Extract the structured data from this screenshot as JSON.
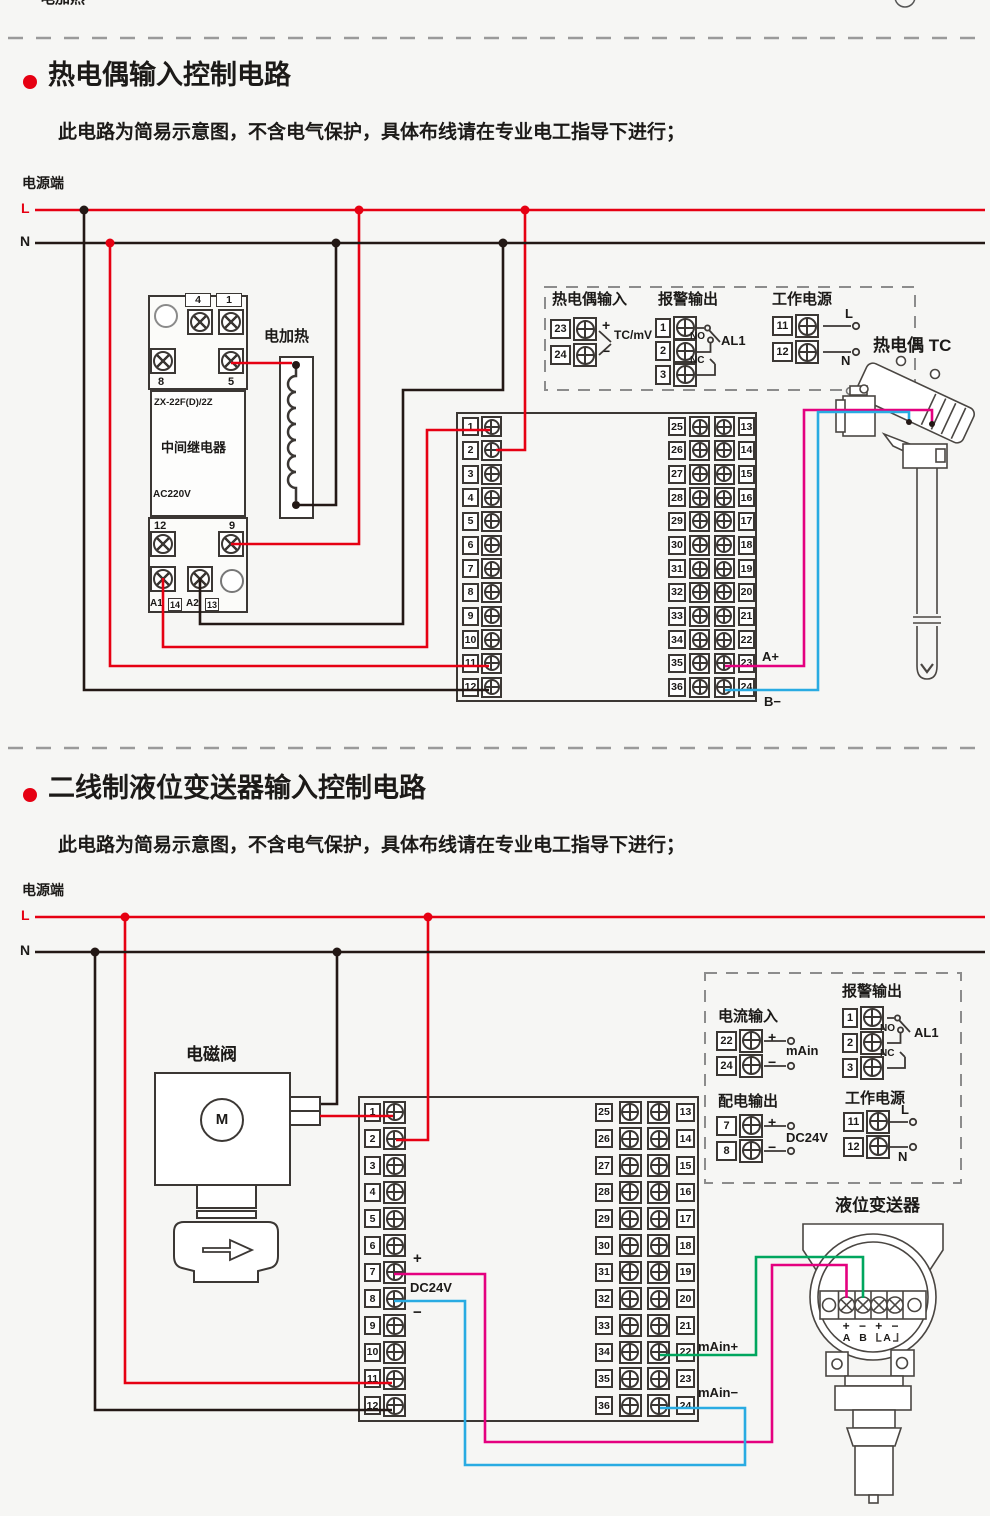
{
  "colors": {
    "red": "#e60012",
    "wire_black": "#231815",
    "magenta": "#e4007f",
    "blue": "#29abe2",
    "green": "#00a65e",
    "outline": "#3b3734"
  },
  "top": {
    "clipped_label": "电加热"
  },
  "terminal_block": {
    "left": [
      "1",
      "2",
      "3",
      "4",
      "5",
      "6",
      "7",
      "8",
      "9",
      "10",
      "11",
      "12"
    ],
    "right": [
      {
        "a": "25",
        "b": "13"
      },
      {
        "a": "26",
        "b": "14"
      },
      {
        "a": "27",
        "b": "15"
      },
      {
        "a": "28",
        "b": "16"
      },
      {
        "a": "29",
        "b": "17"
      },
      {
        "a": "30",
        "b": "18"
      },
      {
        "a": "31",
        "b": "19"
      },
      {
        "a": "32",
        "b": "20"
      },
      {
        "a": "33",
        "b": "21"
      },
      {
        "a": "34",
        "b": "22"
      },
      {
        "a": "35",
        "b": "23"
      },
      {
        "a": "36",
        "b": "24"
      }
    ]
  },
  "section1": {
    "title": "热电偶输入控制电路",
    "subtitle": "此电路为简易示意图，不含电气保护，具体布线请在专业电工指导下进行；",
    "power": {
      "label": "电源端",
      "l": "L",
      "n": "N"
    },
    "relay": {
      "model": "ZX-22F(D)/2Z",
      "name": "中间继电器",
      "voltage": "AC220V",
      "pin_top": [
        "4",
        "1"
      ],
      "pin_mid": [
        "8",
        "5"
      ],
      "pin_low": [
        "12",
        "9"
      ],
      "pin_bottom": [
        "A1",
        "14",
        "A2",
        "13"
      ]
    },
    "heater": {
      "label": "电加热"
    },
    "io_box": {
      "tc": {
        "title": "热电偶输入",
        "rows": [
          {
            "n": "23",
            "s": "+"
          },
          {
            "n": "24",
            "s": "−"
          }
        ],
        "note": "TC/mV"
      },
      "alarm": {
        "title": "报警输出",
        "rows": [
          {
            "n": "1"
          },
          {
            "n": "2"
          },
          {
            "n": "3"
          }
        ],
        "no": "NO",
        "nc": "NC",
        "name": "AL1"
      },
      "power": {
        "title": "工作电源",
        "rows": [
          {
            "n": "11"
          },
          {
            "n": "12"
          }
        ],
        "l": "L",
        "n": "N"
      }
    },
    "block_labels": {
      "a_plus": "A+",
      "b_minus": "B−"
    },
    "tc_sensor": {
      "label": "热电偶 TC"
    }
  },
  "section2": {
    "title": "二线制液位变送器输入控制电路",
    "subtitle": "此电路为简易示意图，不含电气保护，具体布线请在专业电工指导下进行；",
    "power": {
      "label": "电源端",
      "l": "L",
      "n": "N"
    },
    "valve": {
      "label": "电磁阀",
      "motor": "M"
    },
    "io_box": {
      "current": {
        "title": "电流输入",
        "rows": [
          {
            "n": "22",
            "s": "+"
          },
          {
            "n": "24",
            "s": "−"
          }
        ],
        "note": "mAin"
      },
      "alarm": {
        "title": "报警输出",
        "rows": [
          {
            "n": "1"
          },
          {
            "n": "2"
          },
          {
            "n": "3"
          }
        ],
        "no": "NO",
        "nc": "NC",
        "name": "AL1"
      },
      "dist": {
        "title": "配电输出",
        "rows": [
          {
            "n": "7",
            "s": "+"
          },
          {
            "n": "8",
            "s": "−"
          }
        ],
        "note": "DC24V"
      },
      "power": {
        "title": "工作电源",
        "rows": [
          {
            "n": "11"
          },
          {
            "n": "12"
          }
        ],
        "l": "L",
        "n": "N"
      }
    },
    "block_labels": {
      "plus": "+",
      "dc": "DC24V",
      "minus": "−",
      "main_plus": "mAin+",
      "main_minus": "mAin−"
    },
    "transmitter": {
      "label": "液位变送器",
      "polarity": [
        "+",
        "−",
        "+",
        "−"
      ],
      "ab": [
        "A",
        "B",
        "A"
      ]
    }
  }
}
